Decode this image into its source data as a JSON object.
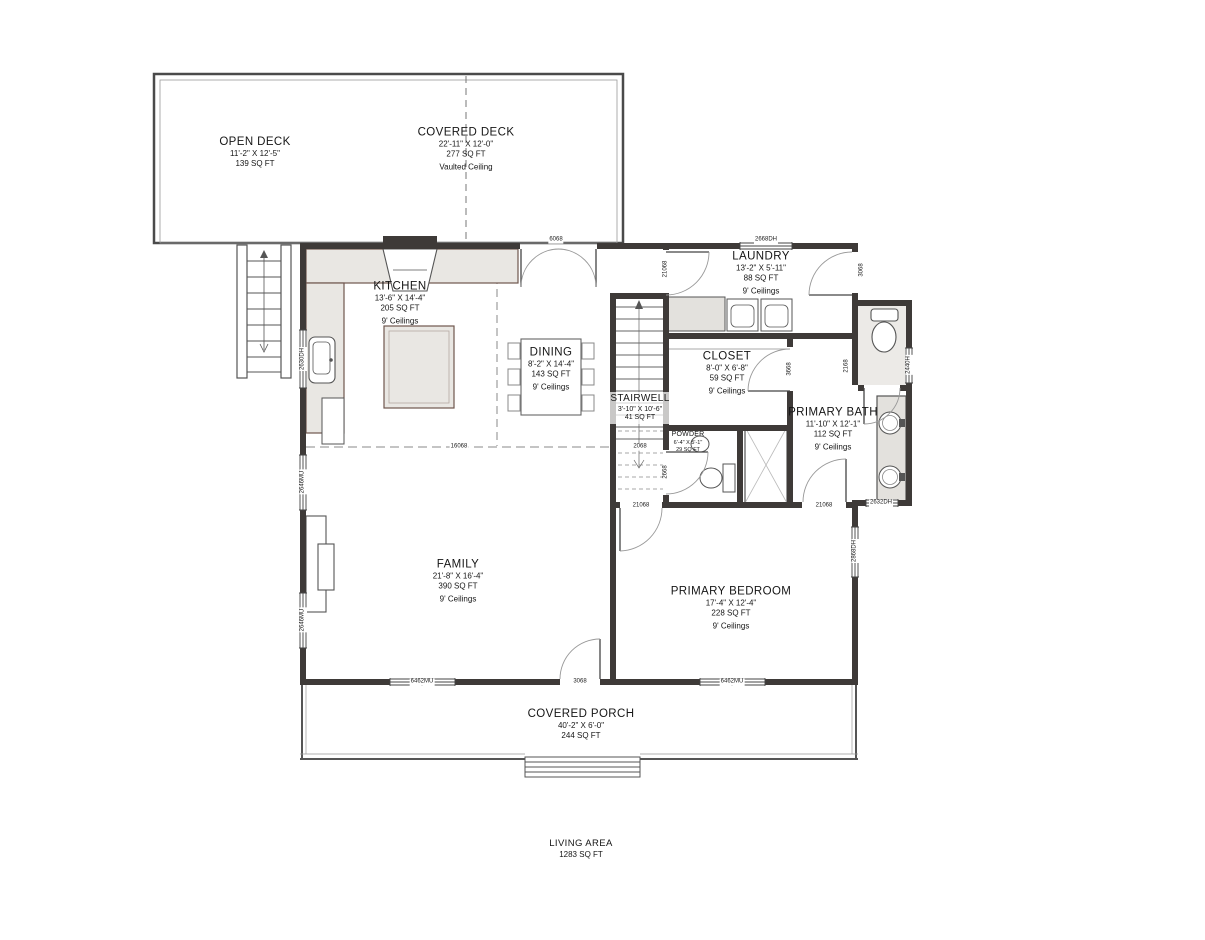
{
  "plan": {
    "title": "Floor Plan",
    "rooms": [
      {
        "id": "open-deck",
        "name": "OPEN DECK",
        "dims": "11'-2\" X 12'-5\"",
        "area": "139 SQ FT",
        "ceiling": ""
      },
      {
        "id": "covered-deck",
        "name": "COVERED DECK",
        "dims": "22'-11\" X 12'-0\"",
        "area": "277 SQ FT",
        "ceiling": "Vaulted Ceiling"
      },
      {
        "id": "kitchen",
        "name": "KITCHEN",
        "dims": "13'-6\" X 14'-4\"",
        "area": "205 SQ FT",
        "ceiling": "9' Ceilings"
      },
      {
        "id": "dining",
        "name": "DINING",
        "dims": "8'-2\" X 14'-4\"",
        "area": "143 SQ FT",
        "ceiling": "9' Ceilings"
      },
      {
        "id": "laundry",
        "name": "LAUNDRY",
        "dims": "13'-2\" X 5'-11\"",
        "area": "88 SQ FT",
        "ceiling": "9' Ceilings"
      },
      {
        "id": "closet",
        "name": "CLOSET",
        "dims": "8'-0\" X 6'-8\"",
        "area": "59 SQ FT",
        "ceiling": "9' Ceilings"
      },
      {
        "id": "stairwell",
        "name": "STAIRWELL",
        "dims": "3'-10\" X 10'-6\"",
        "area": "41 SQ FT",
        "ceiling": ""
      },
      {
        "id": "powder",
        "name": "POWDER",
        "dims": "6'-4\" X 5'-1\"",
        "area": "29 SQ FT",
        "ceiling": ""
      },
      {
        "id": "primary-bath",
        "name": "PRIMARY BATH",
        "dims": "11'-10\" X 12'-1\"",
        "area": "112 SQ FT",
        "ceiling": "9' Ceilings"
      },
      {
        "id": "family",
        "name": "FAMILY",
        "dims": "21'-8\" X 16'-4\"",
        "area": "390 SQ FT",
        "ceiling": "9' Ceilings"
      },
      {
        "id": "primary-bedroom",
        "name": "PRIMARY BEDROOM",
        "dims": "17'-4\" X 12'-4\"",
        "area": "228 SQ FT",
        "ceiling": "9' Ceilings"
      },
      {
        "id": "covered-porch",
        "name": "COVERED PORCH",
        "dims": "40'-2\" X 6'-0\"",
        "area": "244 SQ FT",
        "ceiling": ""
      },
      {
        "id": "living-area",
        "name": "LIVING AREA",
        "dims": "",
        "area": "1283 SQ FT",
        "ceiling": ""
      }
    ],
    "wall_tags": [
      "6068",
      "2668DH",
      "21068",
      "3068",
      "2630DH",
      "2646MU",
      "2646MU",
      "3668",
      "2168",
      "2440H",
      "16068",
      "2068",
      "2668",
      "21068",
      "21068",
      "2632DH",
      "2868DH",
      "6462MU",
      "3068",
      "6462MU"
    ],
    "colors": {
      "wall": "#3e3a38",
      "counter": "#e9e7e3",
      "accent": "#6f564e",
      "dashed": "#8a8a8a",
      "text": "#161616"
    }
  }
}
